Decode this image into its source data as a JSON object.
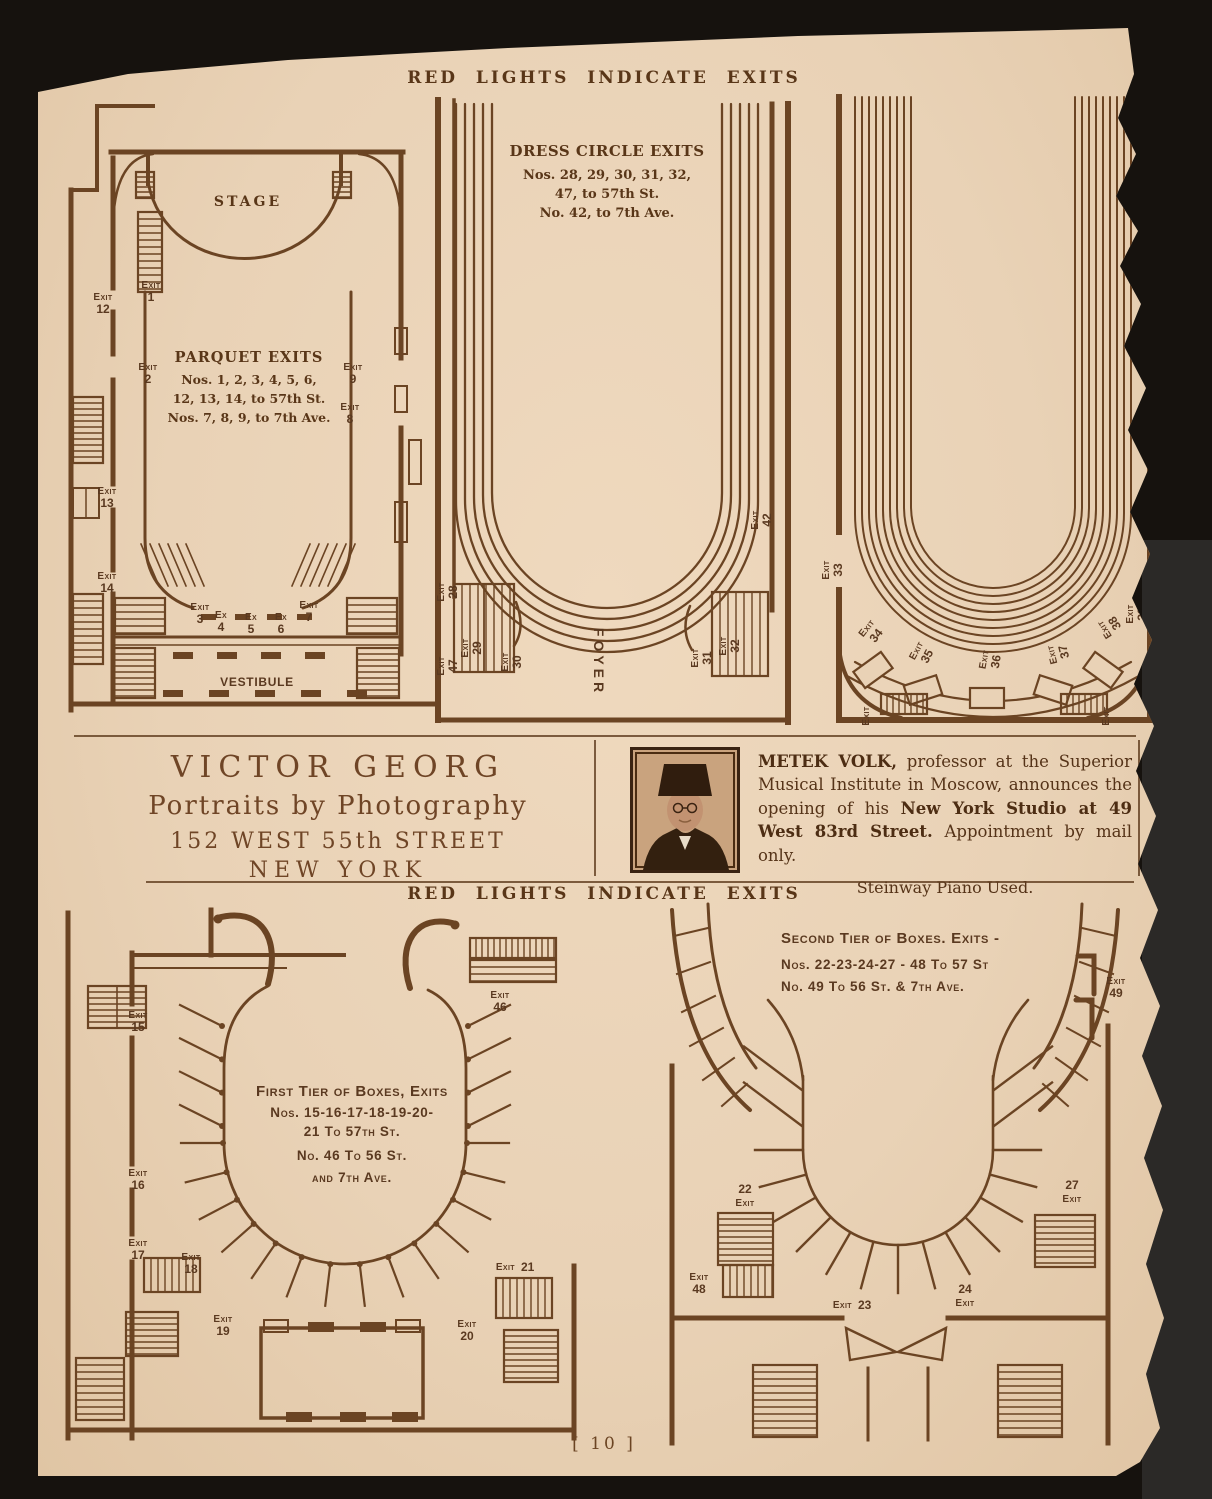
{
  "scan": {
    "background": "#16120e",
    "page_color": "#e9d2b6",
    "ink": "#6b4423",
    "text_ink": "#593618"
  },
  "page": {
    "number": "[ 10 ]"
  },
  "headings": {
    "top": "RED LIGHTS INDICATE EXITS",
    "middle": "RED LIGHTS INDICATE EXITS"
  },
  "labels": {
    "exit": "Exit",
    "ex": "Ex"
  },
  "parquet": {
    "stage": "STAGE",
    "title": "PARQUET EXITS",
    "lines": [
      "Nos. 1, 2, 3, 4, 5, 6,",
      "12, 13, 14, to 57th St.",
      "Nos. 7, 8, 9, to 7th Ave."
    ],
    "vestibule": "VESTIBULE",
    "nums": {
      "n1": "1",
      "n2": "2",
      "n3": "3",
      "n4": "4",
      "n5": "5",
      "n6": "6",
      "n7": "7",
      "n8": "8",
      "n9": "9",
      "n12": "12",
      "n13": "13",
      "n14": "14"
    }
  },
  "dress_circle": {
    "title": "DRESS CIRCLE EXITS",
    "lines": [
      "Nos. 28, 29, 30, 31, 32,",
      "47, to 57th St.",
      "No. 42, to 7th Ave."
    ],
    "foyer": "FOYER",
    "nums": {
      "n28": "28",
      "n29": "29",
      "n30": "30",
      "n31": "31",
      "n32": "32",
      "n42": "42",
      "n47": "47"
    }
  },
  "balcony": {
    "nums": {
      "n33": "33",
      "n34": "34",
      "n35": "35",
      "n36": "36",
      "n37": "37",
      "n38": "38",
      "n39": "39"
    }
  },
  "first_tier": {
    "title": "First Tier of Boxes, Exits",
    "lines": [
      "Nos. 15-16-17-18-19-20-",
      "21 To 57th St.",
      "No. 46 To 56 St.",
      "and 7th Ave."
    ],
    "nums": {
      "n15": "15",
      "n16": "16",
      "n17": "17",
      "n18": "18",
      "n19": "19",
      "n20": "20",
      "n21": "21",
      "n46": "46"
    }
  },
  "second_tier": {
    "lines": [
      "Second Tier of Boxes. Exits -",
      "Nos. 22-23-24-27 - 48 To 57 St",
      "No. 49 To 56 St. & 7th Ave."
    ],
    "nums": {
      "n22": "22",
      "n23": "23",
      "n24": "24",
      "n27": "27",
      "n48": "48",
      "n49": "49"
    }
  },
  "ads": {
    "victor_georg": {
      "line1": "VICTOR GEORG",
      "line2": "Portraits by Photography",
      "line3": "152 WEST 55th STREET",
      "line4": "NEW YORK"
    },
    "metek_volk": {
      "intro_bold": "METEK VOLK,",
      "body1": " professor at the Superior Musical Institute in Moscow, announces the opening of his ",
      "studio_bold": "New York Studio at 49 West 83rd Street.",
      "body2": "  Appointment by mail only.",
      "footer": "Steinway Piano Used."
    }
  }
}
